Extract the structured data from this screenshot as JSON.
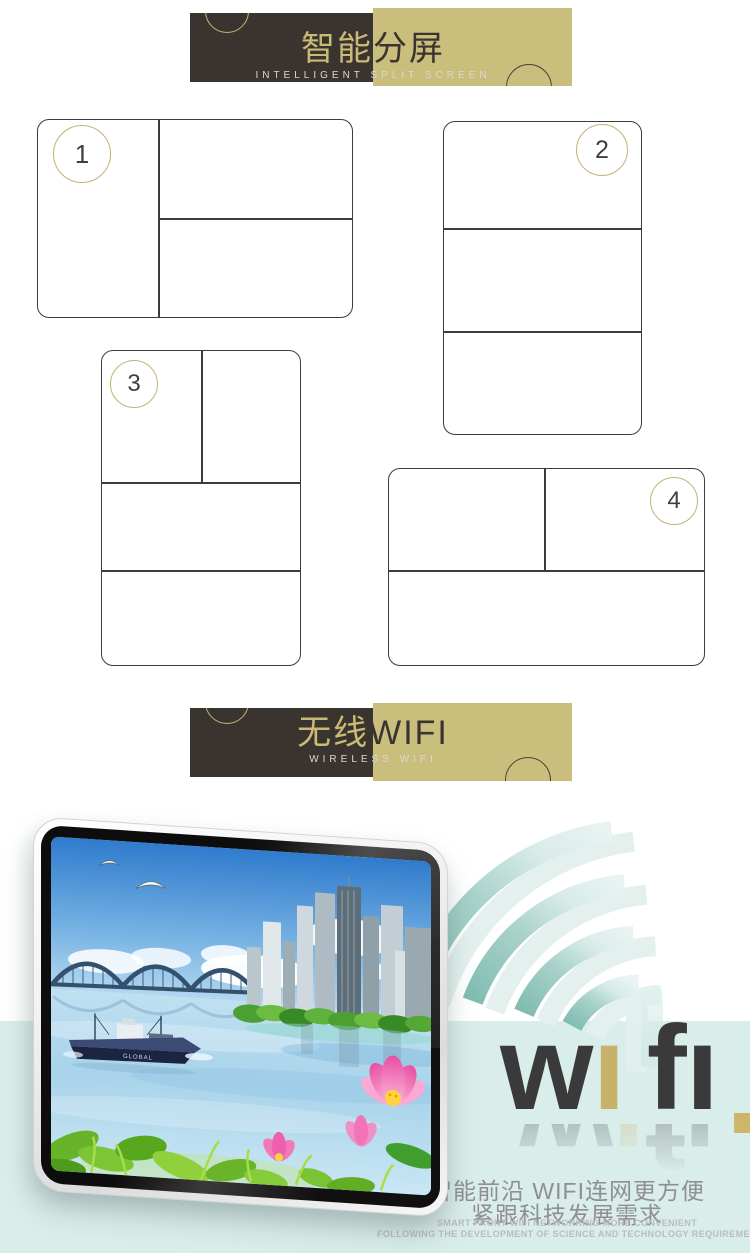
{
  "page": {
    "width": 750,
    "height": 1253,
    "background": "#ffffff"
  },
  "banners": [
    {
      "id": "intelligent-split-screen",
      "title_left": "智能",
      "title_right": "分屏",
      "subtitle": "INTELLIGENT SPLIT SCREEN"
    },
    {
      "id": "wireless-wifi",
      "title_left": "无线",
      "title_right": "WIFI",
      "subtitle": "WIRELESS WIFI"
    }
  ],
  "diagrams": [
    {
      "number": "1",
      "layout": "left column + right split top/bottom"
    },
    {
      "number": "2",
      "layout": "three stacked rows"
    },
    {
      "number": "3",
      "layout": "top split left/right + two rows"
    },
    {
      "number": "4",
      "layout": "top split left/right + one bottom row"
    }
  ],
  "wifi_logo": {
    "word": "wifi",
    "letters": {
      "w": "w",
      "i1": "ı",
      "f": "f",
      "i2": "ı"
    }
  },
  "screen_scene": {
    "ship_label": "GLOBAL",
    "description": "landscape with bridge, city skyline, water, cargo ship, lotus flowers and leaves"
  },
  "bottom": {
    "line1": "智能前沿 WIFI连网更方便",
    "line2": "紧跟科技发展需求",
    "en1": "SMART FRONT WIFI NETWORKING MORE CONVENIENT",
    "en2": "FOLLOWING THE DEVELOPMENT OF SCIENCE AND TECHNOLOGY REQUIREMENTS"
  },
  "colors": {
    "banner_dark": "#3a3430",
    "banner_gold": "#cabe7d",
    "teal_band": "#d9edeb",
    "arc_teal": "#84bcb1",
    "arc_teal_light": "#d7eae7",
    "wifi_text": "#3a3a3a",
    "wifi_gold": "#c8b269",
    "caption_gray": "#8f8f8f",
    "caption_light_gray": "#bcbcbc"
  }
}
